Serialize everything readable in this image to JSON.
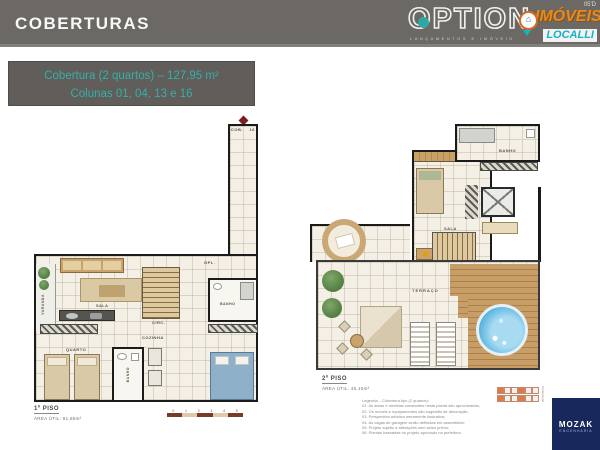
{
  "header": {
    "title": "COBERTURAS",
    "page_code": "05'D",
    "option": {
      "word": "OPTION",
      "tagline": "LANÇAMENTOS E IMÓVEIS",
      "accent": "#2fa8a2"
    },
    "imoveis": {
      "line1": "IMÓVEIS",
      "line2": "LOCALLI",
      "orange": "#e8891f",
      "teal": "#17b3c4"
    }
  },
  "infobox": {
    "line1": "Cobertura (2 quartos) – 127,95 m²",
    "line2": "Colunas 01, 04, 13 e 16",
    "bg": "#605d5a",
    "text_color": "#35b0a8"
  },
  "plan1": {
    "corridor_label": "COB.",
    "corridor_num": "16",
    "labels": {
      "varanda": "VARANDA",
      "sala": "SALA",
      "gpl": "GPL.",
      "circ": "CIRC.",
      "cozinha": "COZINHA",
      "quarto": "QUARTO",
      "banho": "BANHO",
      "banho_suite": "BANHO"
    },
    "title": "1º PISO",
    "area": "ÁREA ÚTIL: 81,85m²"
  },
  "plan2": {
    "labels": {
      "banho": "BANHO",
      "sala": "SALA",
      "terraco": "TERRAÇO"
    },
    "title": "2º PISO",
    "area": "ÁREA ÚTIL: 46,10m²",
    "disclaimer": [
      "Legenda – Cobertura tipo (2 quartos):",
      "01. As áreas e medidas constantes nesta planta são aproximadas;",
      "02. Os móveis e equipamentos são sugestão de decoração;",
      "03. Perspectiva artística meramente ilustrativa;",
      "04. As vagas de garagem serão definidas em assembleia;",
      "05. Projeto sujeito a alterações sem aviso prévio;",
      "06. Plantas baseadas no projeto aprovado na prefeitura."
    ]
  },
  "scalebar": {
    "ticks": [
      "0",
      "1",
      "2",
      "3",
      "4",
      "5"
    ]
  },
  "keyplan": {
    "caption": "implantação"
  },
  "mozak": {
    "name": "MOZAK",
    "sub": "ENGENHARIA"
  }
}
